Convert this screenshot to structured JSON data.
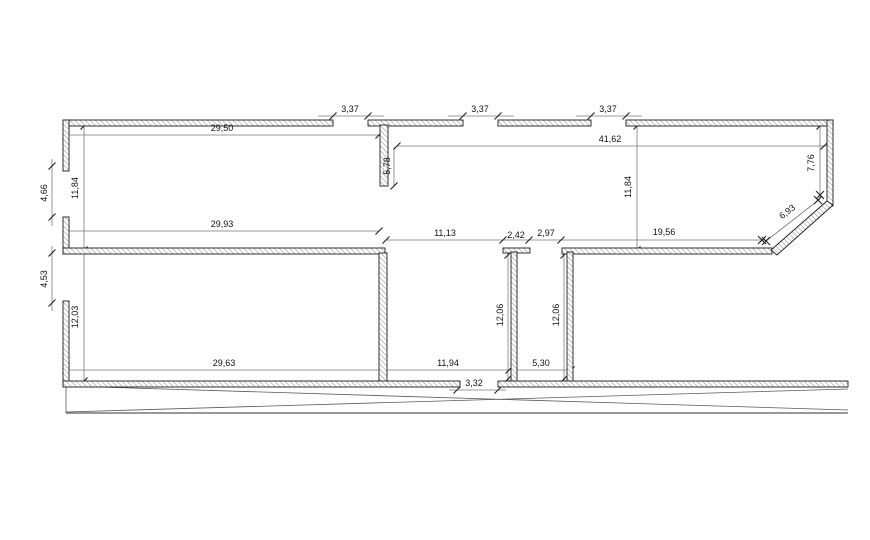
{
  "colors": {
    "background": "#ffffff",
    "wall_stroke": "#1c1c1c",
    "hatch": "#8a8a8a",
    "dim_line": "#7a7a7a",
    "tick": "#1c1c1c",
    "site_line": "#5a5a5a",
    "label": "#111111"
  },
  "drawing": {
    "canvas": {
      "width": 870,
      "height": 540
    },
    "walls": [
      {
        "name": "top-wall-segment-1",
        "x": 64,
        "y": 120,
        "w": 269,
        "h": 6
      },
      {
        "name": "top-wall-segment-2",
        "x": 368,
        "y": 120,
        "w": 95,
        "h": 6
      },
      {
        "name": "top-wall-segment-3",
        "x": 498,
        "y": 120,
        "w": 93,
        "h": 6
      },
      {
        "name": "top-wall-segment-4",
        "x": 626,
        "y": 120,
        "w": 207,
        "h": 6
      },
      {
        "name": "left-wall-segment-1",
        "x": 63,
        "y": 120,
        "w": 6,
        "h": 51
      },
      {
        "name": "left-wall-segment-2",
        "x": 63,
        "y": 217,
        "w": 6,
        "h": 37
      },
      {
        "name": "left-wall-segment-3",
        "x": 63,
        "y": 301,
        "w": 6,
        "h": 85
      },
      {
        "name": "middle-wall-segment-1",
        "x": 63,
        "y": 248,
        "w": 322,
        "h": 6
      },
      {
        "name": "middle-wall-cap-1",
        "x": 503,
        "y": 248,
        "w": 27,
        "h": 5
      },
      {
        "name": "middle-wall-segment-2",
        "x": 562,
        "y": 248,
        "w": 210,
        "h": 6
      },
      {
        "name": "stub-wall-top",
        "x": 380,
        "y": 125,
        "w": 8,
        "h": 61
      },
      {
        "name": "partition-wall-large",
        "x": 379,
        "y": 253,
        "w": 8,
        "h": 129
      },
      {
        "name": "partition-wall-stem-1",
        "x": 511,
        "y": 252,
        "w": 6,
        "h": 130
      },
      {
        "name": "partition-wall-stem-2",
        "x": 567,
        "y": 252,
        "w": 6,
        "h": 130
      },
      {
        "name": "right-wall",
        "x": 827,
        "y": 120,
        "w": 6,
        "h": 86
      },
      {
        "name": "bottom-wall-segment-1",
        "x": 63,
        "y": 381,
        "w": 397,
        "h": 6
      },
      {
        "name": "bottom-wall-segment-2",
        "x": 498,
        "y": 381,
        "w": 350,
        "h": 6
      }
    ],
    "diagonal_walls": [
      {
        "name": "corner-bevel-wall",
        "points": [
          [
            827,
            201
          ],
          [
            833,
            205
          ],
          [
            777,
            255
          ],
          [
            771,
            250
          ]
        ]
      }
    ],
    "dim_lines": [
      {
        "name": "dim-line-29-50",
        "x1": 66,
        "y1": 135,
        "x2": 379,
        "y2": 135
      },
      {
        "name": "dim-line-3-37a",
        "x1": 318,
        "y1": 116,
        "x2": 384,
        "y2": 116
      },
      {
        "name": "dim-line-3-37b",
        "x1": 448,
        "y1": 116,
        "x2": 514,
        "y2": 116
      },
      {
        "name": "dim-line-3-37c",
        "x1": 576,
        "y1": 116,
        "x2": 642,
        "y2": 116
      },
      {
        "name": "dim-line-41-62",
        "x1": 397,
        "y1": 146,
        "x2": 830,
        "y2": 146
      },
      {
        "name": "dim-line-29-93",
        "x1": 66,
        "y1": 231,
        "x2": 379,
        "y2": 231
      },
      {
        "name": "dim-line-middle-row",
        "x1": 386,
        "y1": 240,
        "x2": 766,
        "y2": 240
      },
      {
        "name": "dim-line-bottom-row",
        "x1": 66,
        "y1": 370,
        "x2": 572,
        "y2": 370
      },
      {
        "name": "dim-line-3-32",
        "x1": 449,
        "y1": 390,
        "x2": 506,
        "y2": 390
      },
      {
        "name": "dim-line-4-66",
        "x1": 52,
        "y1": 159,
        "x2": 52,
        "y2": 226
      },
      {
        "name": "dim-line-4-53",
        "x1": 52,
        "y1": 246,
        "x2": 52,
        "y2": 311
      },
      {
        "name": "dim-line-left-heights",
        "x1": 84,
        "y1": 122,
        "x2": 84,
        "y2": 386
      },
      {
        "name": "dim-line-11-84b",
        "x1": 637,
        "y1": 123,
        "x2": 637,
        "y2": 253
      },
      {
        "name": "dim-line-12-06a",
        "x1": 508,
        "y1": 253,
        "x2": 508,
        "y2": 381
      },
      {
        "name": "dim-line-12-06b",
        "x1": 564,
        "y1": 253,
        "x2": 564,
        "y2": 381
      },
      {
        "name": "dim-line-7-76",
        "x1": 820,
        "y1": 122,
        "x2": 820,
        "y2": 197
      },
      {
        "name": "dim-line-5-78",
        "x1": 394,
        "y1": 147,
        "x2": 394,
        "y2": 186
      },
      {
        "name": "dim-line-6-93",
        "x1": 820,
        "y1": 199,
        "x2": 766,
        "y2": 241
      }
    ],
    "ticks": [
      [
        66,
        135
      ],
      [
        379,
        135
      ],
      [
        333,
        116
      ],
      [
        368,
        116
      ],
      [
        463,
        116
      ],
      [
        498,
        116
      ],
      [
        591,
        116
      ],
      [
        626,
        116
      ],
      [
        397,
        146
      ],
      [
        824,
        146
      ],
      [
        66,
        231
      ],
      [
        379,
        231
      ],
      [
        386,
        240
      ],
      [
        503,
        240
      ],
      [
        529,
        240
      ],
      [
        561,
        240
      ],
      [
        66,
        370
      ],
      [
        383,
        370
      ],
      [
        509,
        370
      ],
      [
        571,
        370
      ],
      [
        457,
        390
      ],
      [
        498,
        390
      ],
      [
        52,
        166
      ],
      [
        52,
        217
      ],
      [
        52,
        253
      ],
      [
        52,
        303
      ],
      [
        84,
        126
      ],
      [
        84,
        250
      ],
      [
        84,
        381
      ],
      [
        637,
        126
      ],
      [
        637,
        250
      ],
      [
        508,
        255
      ],
      [
        508,
        379
      ],
      [
        564,
        255
      ],
      [
        564,
        379
      ],
      [
        820,
        126
      ],
      [
        394,
        186
      ]
    ],
    "x_marks": [
      [
        762,
        240
      ],
      [
        766,
        241
      ],
      [
        818,
        200
      ],
      [
        820,
        195
      ]
    ],
    "site_lines": [
      {
        "name": "site-line-cross-down",
        "x1": 66,
        "y1": 386,
        "x2": 848,
        "y2": 410,
        "w": 0.8
      },
      {
        "name": "site-line-cross-up",
        "x1": 66,
        "y1": 412,
        "x2": 848,
        "y2": 389,
        "w": 0.8
      },
      {
        "name": "site-line-base",
        "x1": 66,
        "y1": 413,
        "x2": 848,
        "y2": 413,
        "w": 1.3
      },
      {
        "name": "site-line-left-edge",
        "x1": 66,
        "y1": 386,
        "x2": 66,
        "y2": 413,
        "w": 0.8
      }
    ],
    "labels": [
      {
        "text": "29,50",
        "x": 222,
        "y": 131,
        "rot": 0
      },
      {
        "text": "3,37",
        "x": 350,
        "y": 112,
        "rot": 0
      },
      {
        "text": "3,37",
        "x": 480,
        "y": 112,
        "rot": 0
      },
      {
        "text": "3,37",
        "x": 608,
        "y": 112,
        "rot": 0
      },
      {
        "text": "41,62",
        "x": 610,
        "y": 142,
        "rot": 0
      },
      {
        "text": "5,78",
        "x": 390,
        "y": 166,
        "rot": -90
      },
      {
        "text": "11,84",
        "x": 78,
        "y": 188,
        "rot": -90
      },
      {
        "text": "4,66",
        "x": 47,
        "y": 193,
        "rot": -90
      },
      {
        "text": "11,84",
        "x": 631,
        "y": 187,
        "rot": -90
      },
      {
        "text": "7,76",
        "x": 814,
        "y": 163,
        "rot": -90
      },
      {
        "text": "6,93",
        "x": 789,
        "y": 214,
        "rot": -38
      },
      {
        "text": "29,93",
        "x": 222,
        "y": 227,
        "rot": 0
      },
      {
        "text": "11,13",
        "x": 445,
        "y": 236,
        "rot": 0
      },
      {
        "text": "2,42",
        "x": 516,
        "y": 238,
        "rot": 0
      },
      {
        "text": "2,97",
        "x": 546,
        "y": 236,
        "rot": 0
      },
      {
        "text": "19,56",
        "x": 664,
        "y": 235,
        "rot": 0
      },
      {
        "text": "4,53",
        "x": 47,
        "y": 279,
        "rot": -90
      },
      {
        "text": "12,03",
        "x": 78,
        "y": 317,
        "rot": -90
      },
      {
        "text": "12,06",
        "x": 503,
        "y": 315,
        "rot": -90
      },
      {
        "text": "12,06",
        "x": 559,
        "y": 315,
        "rot": -90
      },
      {
        "text": "29,63",
        "x": 224,
        "y": 366,
        "rot": 0
      },
      {
        "text": "11,94",
        "x": 448,
        "y": 366,
        "rot": 0
      },
      {
        "text": "5,30",
        "x": 541,
        "y": 366,
        "rot": 0
      },
      {
        "text": "3,32",
        "x": 474,
        "y": 386,
        "rot": 0
      }
    ]
  }
}
